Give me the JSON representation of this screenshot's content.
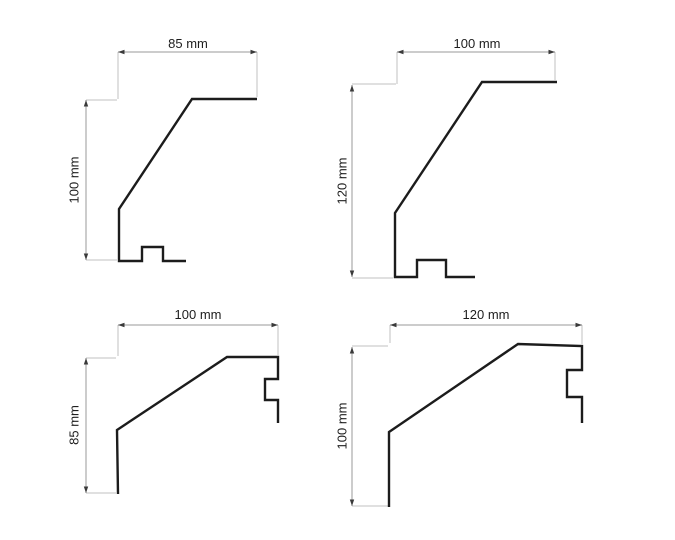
{
  "colors": {
    "background": "#ffffff",
    "profile_stroke": "#1c1c1c",
    "dimension_line": "#9a9a9a",
    "extension_line": "#c0c0c0",
    "arrow": "#3a3a3a",
    "label_text": "#1e1e1e"
  },
  "diagrams": [
    {
      "id": "top-left",
      "width_label": "85 mm",
      "height_label": "100 mm",
      "width_mm": 85,
      "height_mm": 100,
      "profile_points": "257,99 192,99 119,209 119,261 142,261 142,247 163,247 163,261 186,261",
      "h_dim": {
        "x1": 118,
        "x2": 257,
        "y": 52,
        "label_x": 188,
        "label_y": 48
      },
      "v_dim": {
        "x": 86,
        "y1": 100,
        "y2": 260,
        "label_x": 74,
        "label_y": 180
      },
      "extensions": [
        [
          118,
          52,
          118,
          99
        ],
        [
          257,
          52,
          257,
          97
        ],
        [
          86,
          100,
          117,
          100
        ],
        [
          86,
          260,
          117,
          260
        ]
      ]
    },
    {
      "id": "top-right",
      "width_label": "100 mm",
      "height_label": "120 mm",
      "width_mm": 100,
      "height_mm": 120,
      "profile_points": "557,82 482,82 395,213 395,277 417,277 417,260 446,260 446,277 475,277",
      "h_dim": {
        "x1": 397,
        "x2": 555,
        "y": 52,
        "label_x": 477,
        "label_y": 48
      },
      "v_dim": {
        "x": 352,
        "y1": 85,
        "y2": 277,
        "label_x": 342,
        "label_y": 181
      },
      "extensions": [
        [
          397,
          52,
          397,
          84
        ],
        [
          555,
          52,
          555,
          80
        ],
        [
          352,
          84,
          396,
          84
        ],
        [
          352,
          278,
          393,
          278
        ]
      ]
    },
    {
      "id": "bottom-left",
      "width_label": "100 mm",
      "height_label": "85 mm",
      "width_mm": 100,
      "height_mm": 85,
      "profile_points": "118,494 117,430 227,357 278,357 278,379 265,379 265,400 278,400 278,423",
      "h_dim": {
        "x1": 118,
        "x2": 278,
        "y": 325,
        "label_x": 198,
        "label_y": 319
      },
      "v_dim": {
        "x": 86,
        "y1": 358,
        "y2": 493,
        "label_x": 74,
        "label_y": 425
      },
      "extensions": [
        [
          118,
          325,
          118,
          356
        ],
        [
          278,
          325,
          278,
          355
        ],
        [
          86,
          358,
          116,
          358
        ],
        [
          86,
          493,
          116,
          493
        ]
      ]
    },
    {
      "id": "bottom-right",
      "width_label": "120 mm",
      "height_label": "100 mm",
      "width_mm": 120,
      "height_mm": 100,
      "profile_points": "389,507 389,432 518,344 582,346 582,370 567,370 567,397 582,397 582,423",
      "h_dim": {
        "x1": 390,
        "x2": 582,
        "y": 325,
        "label_x": 486,
        "label_y": 319
      },
      "v_dim": {
        "x": 352,
        "y1": 347,
        "y2": 506,
        "label_x": 342,
        "label_y": 426
      },
      "extensions": [
        [
          390,
          325,
          390,
          343
        ],
        [
          582,
          325,
          582,
          344
        ],
        [
          352,
          346,
          388,
          346
        ],
        [
          352,
          506,
          388,
          506
        ]
      ]
    }
  ]
}
